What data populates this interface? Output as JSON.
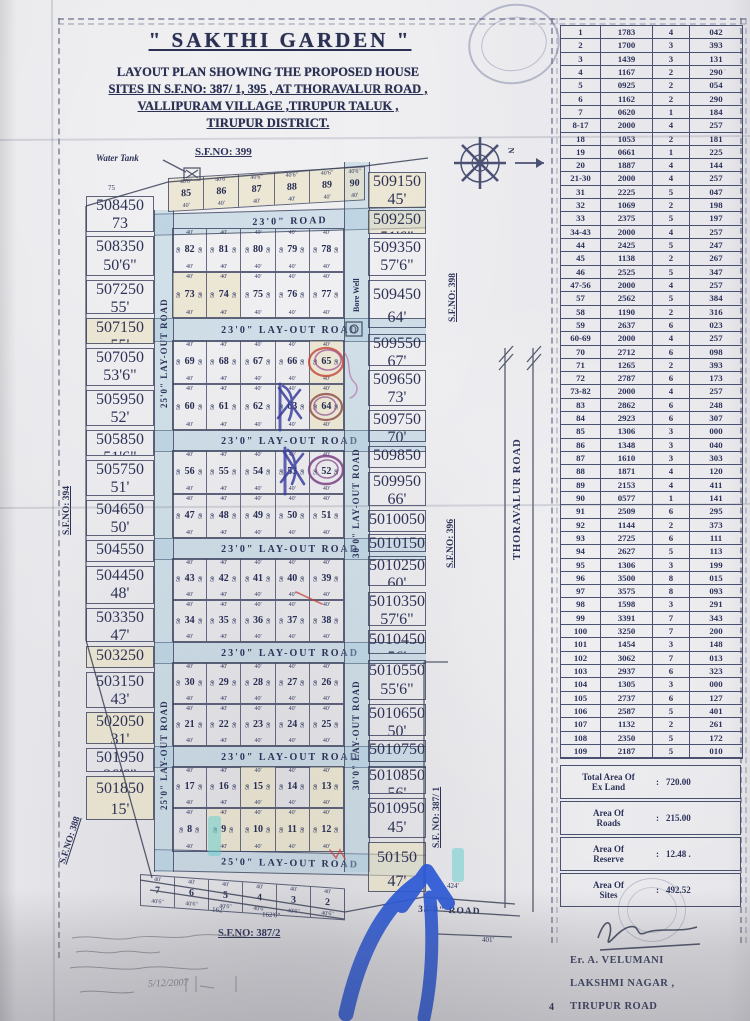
{
  "title": {
    "main": "\" SAKTHI GARDEN \"",
    "sub1": "LAYOUT PLAN SHOWING THE PROPOSED HOUSE",
    "sub2": "SITES IN S.F.NO: 387/ 1, 395 , AT THORAVALUR ROAD ,",
    "sub3": "VALLIPURAM VILLAGE ,TIRUPUR TALUK ,",
    "sub4": "TIRUPUR DISTRICT."
  },
  "plot_table": {
    "rows": [
      [
        "1",
        "1783",
        "4",
        "042"
      ],
      [
        "2",
        "1700",
        "3",
        "393"
      ],
      [
        "3",
        "1439",
        "3",
        "131"
      ],
      [
        "4",
        "1167",
        "2",
        "290"
      ],
      [
        "5",
        "0925",
        "2",
        "054"
      ],
      [
        "6",
        "1162",
        "2",
        "290"
      ],
      [
        "7",
        "0620",
        "1",
        "184"
      ],
      [
        "8-17",
        "2000",
        "4",
        "257"
      ],
      [
        "18",
        "1053",
        "2",
        "181"
      ],
      [
        "19",
        "0661",
        "1",
        "225"
      ],
      [
        "20",
        "1887",
        "4",
        "144"
      ],
      [
        "21-30",
        "2000",
        "4",
        "257"
      ],
      [
        "31",
        "2225",
        "5",
        "047"
      ],
      [
        "32",
        "1069",
        "2",
        "198"
      ],
      [
        "33",
        "2375",
        "5",
        "197"
      ],
      [
        "34-43",
        "2000",
        "4",
        "257"
      ],
      [
        "44",
        "2425",
        "5",
        "247"
      ],
      [
        "45",
        "1138",
        "2",
        "267"
      ],
      [
        "46",
        "2525",
        "5",
        "347"
      ],
      [
        "47-56",
        "2000",
        "4",
        "257"
      ],
      [
        "57",
        "2562",
        "5",
        "384"
      ],
      [
        "58",
        "1190",
        "2",
        "316"
      ],
      [
        "59",
        "2637",
        "6",
        "023"
      ],
      [
        "60-69",
        "2000",
        "4",
        "257"
      ],
      [
        "70",
        "2712",
        "6",
        "098"
      ],
      [
        "71",
        "1265",
        "2",
        "393"
      ],
      [
        "72",
        "2787",
        "6",
        "173"
      ],
      [
        "73-82",
        "2000",
        "4",
        "257"
      ],
      [
        "83",
        "2862",
        "6",
        "248"
      ],
      [
        "84",
        "2923",
        "6",
        "307"
      ],
      [
        "85",
        "1306",
        "3",
        "000"
      ],
      [
        "86",
        "1348",
        "3",
        "040"
      ],
      [
        "87",
        "1610",
        "3",
        "303"
      ],
      [
        "88",
        "1871",
        "4",
        "120"
      ],
      [
        "89",
        "2153",
        "4",
        "411"
      ],
      [
        "90",
        "0577",
        "1",
        "141"
      ],
      [
        "91",
        "2509",
        "6",
        "295"
      ],
      [
        "92",
        "1144",
        "2",
        "373"
      ],
      [
        "93",
        "2725",
        "6",
        "111"
      ],
      [
        "94",
        "2627",
        "5",
        "113"
      ],
      [
        "95",
        "1306",
        "3",
        "199"
      ],
      [
        "96",
        "3500",
        "8",
        "015"
      ],
      [
        "97",
        "3575",
        "8",
        "093"
      ],
      [
        "98",
        "1598",
        "3",
        "291"
      ],
      [
        "99",
        "3391",
        "7",
        "343"
      ],
      [
        "100",
        "3250",
        "7",
        "200"
      ],
      [
        "101",
        "1454",
        "3",
        "148"
      ],
      [
        "102",
        "3062",
        "7",
        "013"
      ],
      [
        "103",
        "2937",
        "6",
        "323"
      ],
      [
        "104",
        "1305",
        "3",
        "000"
      ],
      [
        "105",
        "2737",
        "6",
        "127"
      ],
      [
        "106",
        "2587",
        "5",
        "401"
      ],
      [
        "107",
        "1132",
        "2",
        "261"
      ],
      [
        "108",
        "2350",
        "5",
        "172"
      ],
      [
        "109",
        "2187",
        "5",
        "010"
      ]
    ]
  },
  "totals": [
    {
      "label1": "Total Area Of",
      "label2": "Ex Land",
      "value": "720.00"
    },
    {
      "label1": "Area Of",
      "label2": "Roads",
      "value": "215.00"
    },
    {
      "label1": "Area Of",
      "label2": "Reserve",
      "value": "12.48 ."
    },
    {
      "label1": "Area Of",
      "label2": "Sites",
      "value": "492.52"
    }
  ],
  "signature": {
    "name": "Er. A. VELUMANI",
    "line2": "LAKSHMI NAGAR ,",
    "line3": "TIRUPUR ROAD",
    "corner": "4"
  },
  "map": {
    "sf_labels": {
      "top": "S.F.NO: 399",
      "left": "S.F.NO: 394",
      "left_bottom": "S.F.NO: 388",
      "right_top": "S.F.NO: 398",
      "right_mid": "S.F.NO: 396",
      "right_bottom": "S.F. NO: 387/ 1",
      "bottom": "S.F.NO: 387/2"
    },
    "water_tank": "Water Tank",
    "bore_well": "Bore Well",
    "roads": {
      "top": "23'0\"  ROAD",
      "layout": "23'0\" LAY-OUT ROAD",
      "left_vert": "25'0\" LAY-OUT ROAD",
      "right_vert": "30'0\" LAY-OUT ROAD",
      "bottom": "25'0\" LAY-OUT ROAD",
      "bottom_right": "35'0\" ROAD",
      "thoravalur": "THORAVALUR ROAD"
    },
    "dims": {
      "cell": "40'",
      "cell6": "40'6\"",
      "side": "50",
      "d424": "424'",
      "d401": "401'",
      "d162": "162'",
      "d162b": "162'6\"",
      "n": "N",
      "d75": "75"
    },
    "top_strip": [
      "85",
      "86",
      "87",
      "88",
      "89",
      "90"
    ],
    "left_col": [
      {
        "n": "84",
        "d": "73"
      },
      {
        "n": "83",
        "d": "50'6\""
      },
      {
        "n": "72",
        "d": "55'"
      },
      {
        "n": "71",
        "d": "55'"
      },
      {
        "n": "70",
        "d": "53'6\""
      },
      {
        "n": "59",
        "d": "52'"
      },
      {
        "n": "58",
        "d": "51'6\""
      },
      {
        "n": "57",
        "d": "51'"
      },
      {
        "n": "46",
        "d": "50'"
      },
      {
        "n": "45",
        "d": "49'"
      },
      {
        "n": "44",
        "d": "48'"
      },
      {
        "n": "33",
        "d": "47'"
      },
      {
        "n": "32",
        "d": "46'"
      },
      {
        "n": "31",
        "d": "43'"
      },
      {
        "n": "20",
        "d": "31'"
      },
      {
        "n": "19",
        "d": "26'6\""
      },
      {
        "n": "18",
        "d": "15'"
      }
    ],
    "grid": [
      {
        "plots": [
          "82",
          "81",
          "80",
          "79",
          "78"
        ]
      },
      {
        "plots": [
          "73",
          "74",
          "75",
          "76",
          "77"
        ]
      },
      {
        "plots": [
          "69",
          "68",
          "67",
          "66",
          "65"
        ]
      },
      {
        "plots": [
          "60",
          "61",
          "62",
          "63",
          "64"
        ]
      },
      {
        "plots": [
          "56",
          "55",
          "54",
          "53",
          "52"
        ]
      },
      {
        "plots": [
          "47",
          "48",
          "49",
          "50",
          "51"
        ]
      },
      {
        "plots": [
          "43",
          "42",
          "41",
          "40",
          "39"
        ]
      },
      {
        "plots": [
          "34",
          "35",
          "36",
          "37",
          "38"
        ]
      },
      {
        "plots": [
          "30",
          "29",
          "28",
          "27",
          "26"
        ]
      },
      {
        "plots": [
          "21",
          "22",
          "23",
          "24",
          "25"
        ]
      },
      {
        "plots": [
          "17",
          "16",
          "15",
          "14",
          "13"
        ]
      },
      {
        "plots": [
          "8",
          "9",
          "10",
          "11",
          "12"
        ]
      }
    ],
    "right_col": [
      {
        "n": "91",
        "d": "45'"
      },
      {
        "n": "92",
        "d": "51'6\""
      },
      {
        "n": "93",
        "d": "57'6\""
      },
      {
        "n": "94",
        "d": "64'"
      },
      {
        "n": "95",
        "d": "67'"
      },
      {
        "n": "96",
        "d": "73'"
      },
      {
        "n": "97",
        "d": "70'"
      },
      {
        "n": "98",
        "d": "69'"
      },
      {
        "n": "99",
        "d": "66'"
      },
      {
        "n": "100",
        "d": "65'"
      },
      {
        "n": "101",
        "d": "52'6\""
      },
      {
        "n": "102",
        "d": "60'"
      },
      {
        "n": "103",
        "d": "57'6\""
      },
      {
        "n": "104",
        "d": "56'"
      },
      {
        "n": "105",
        "d": "55'6\""
      },
      {
        "n": "106",
        "d": "50'"
      },
      {
        "n": "107",
        "d": "51'6\""
      },
      {
        "n": "108",
        "d": "56'"
      },
      {
        "n": "109",
        "d": "45'"
      },
      {
        "n": "1",
        "d": "47'"
      }
    ],
    "bottom_row": [
      "7",
      "6",
      "5",
      "4",
      "3",
      "2"
    ],
    "date_note": "5/12/2007"
  }
}
